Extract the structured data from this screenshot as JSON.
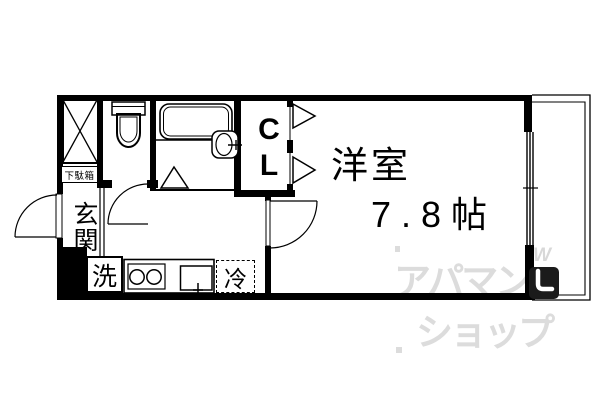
{
  "floor_plan": {
    "room": {
      "name": "洋室",
      "size": "7.8帖"
    },
    "closet": {
      "label": "C\nL"
    },
    "entrance": {
      "label": "玄関"
    },
    "washer": {
      "label": "洗"
    },
    "fridge": {
      "label": "冷"
    },
    "shoe_cabinet": {
      "label": "下駄箱"
    }
  },
  "watermark": {
    "line1": "アパマン",
    "line2": "ショップ",
    "logo_w": "W"
  },
  "colors": {
    "line": "#000000",
    "background": "#ffffff",
    "watermark": "#dcdcdc",
    "logo_background": "#1b1b1b"
  }
}
